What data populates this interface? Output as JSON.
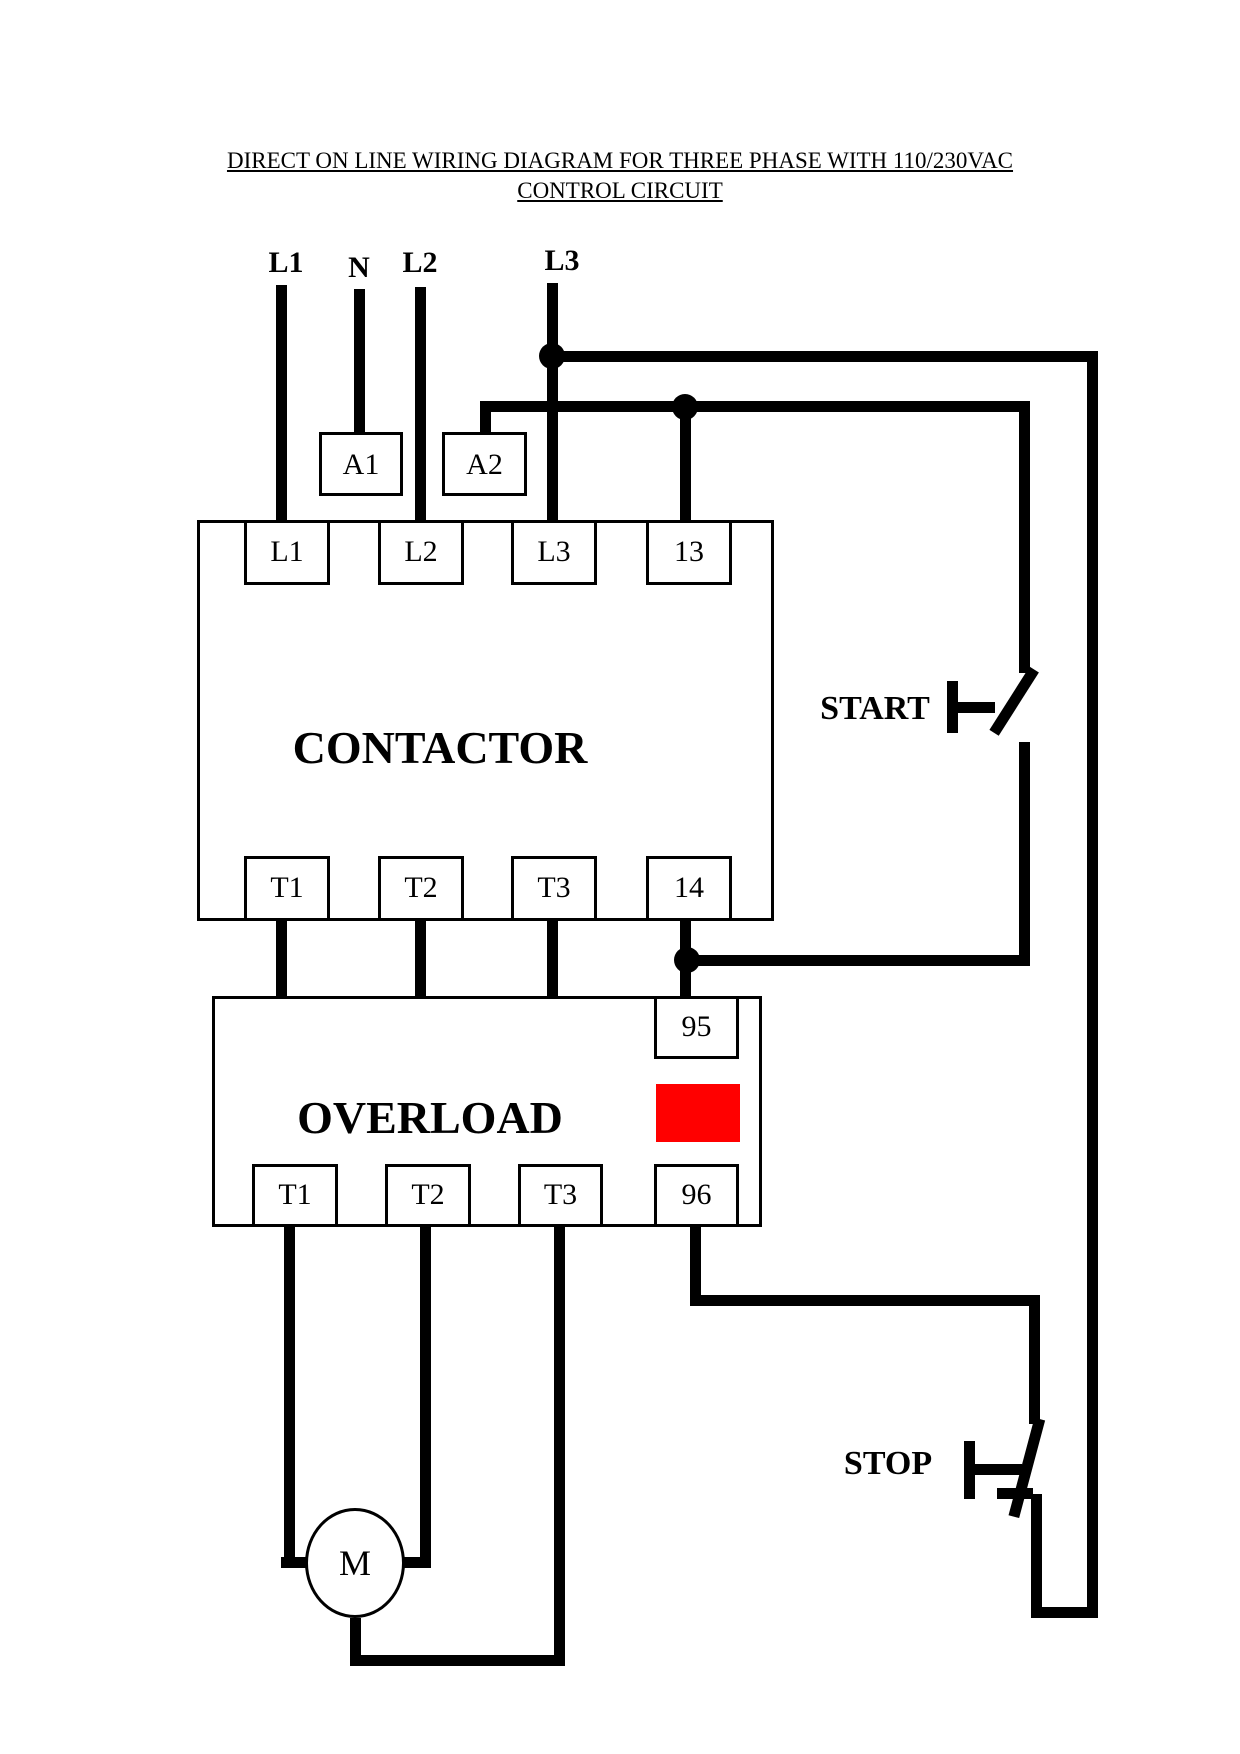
{
  "page": {
    "background": "#ffffff",
    "wire_color": "#000000"
  },
  "title": {
    "line1": "DIRECT ON LINE WIRING DIAGRAM FOR THREE PHASE WITH 110/230VAC",
    "line2": "CONTROL CIRCUIT"
  },
  "supply": {
    "l1": "L1",
    "n": "N",
    "l2": "L2",
    "l3": "L3"
  },
  "contactor": {
    "label": "CONTACTOR",
    "top_terminals": [
      "L1",
      "L2",
      "L3",
      "13"
    ],
    "bottom_terminals": [
      "T1",
      "T2",
      "T3",
      "14"
    ],
    "coil_terminals": {
      "a1": "A1",
      "a2": "A2"
    }
  },
  "overload": {
    "label": "OVERLOAD",
    "aux_top_terminal": "95",
    "aux_bottom_terminal": "96",
    "bottom_terminals": [
      "T1",
      "T2",
      "T3"
    ],
    "indicator_color": "#ff0000"
  },
  "controls": {
    "start": "START",
    "stop": "STOP"
  },
  "motor": {
    "label": "M"
  }
}
